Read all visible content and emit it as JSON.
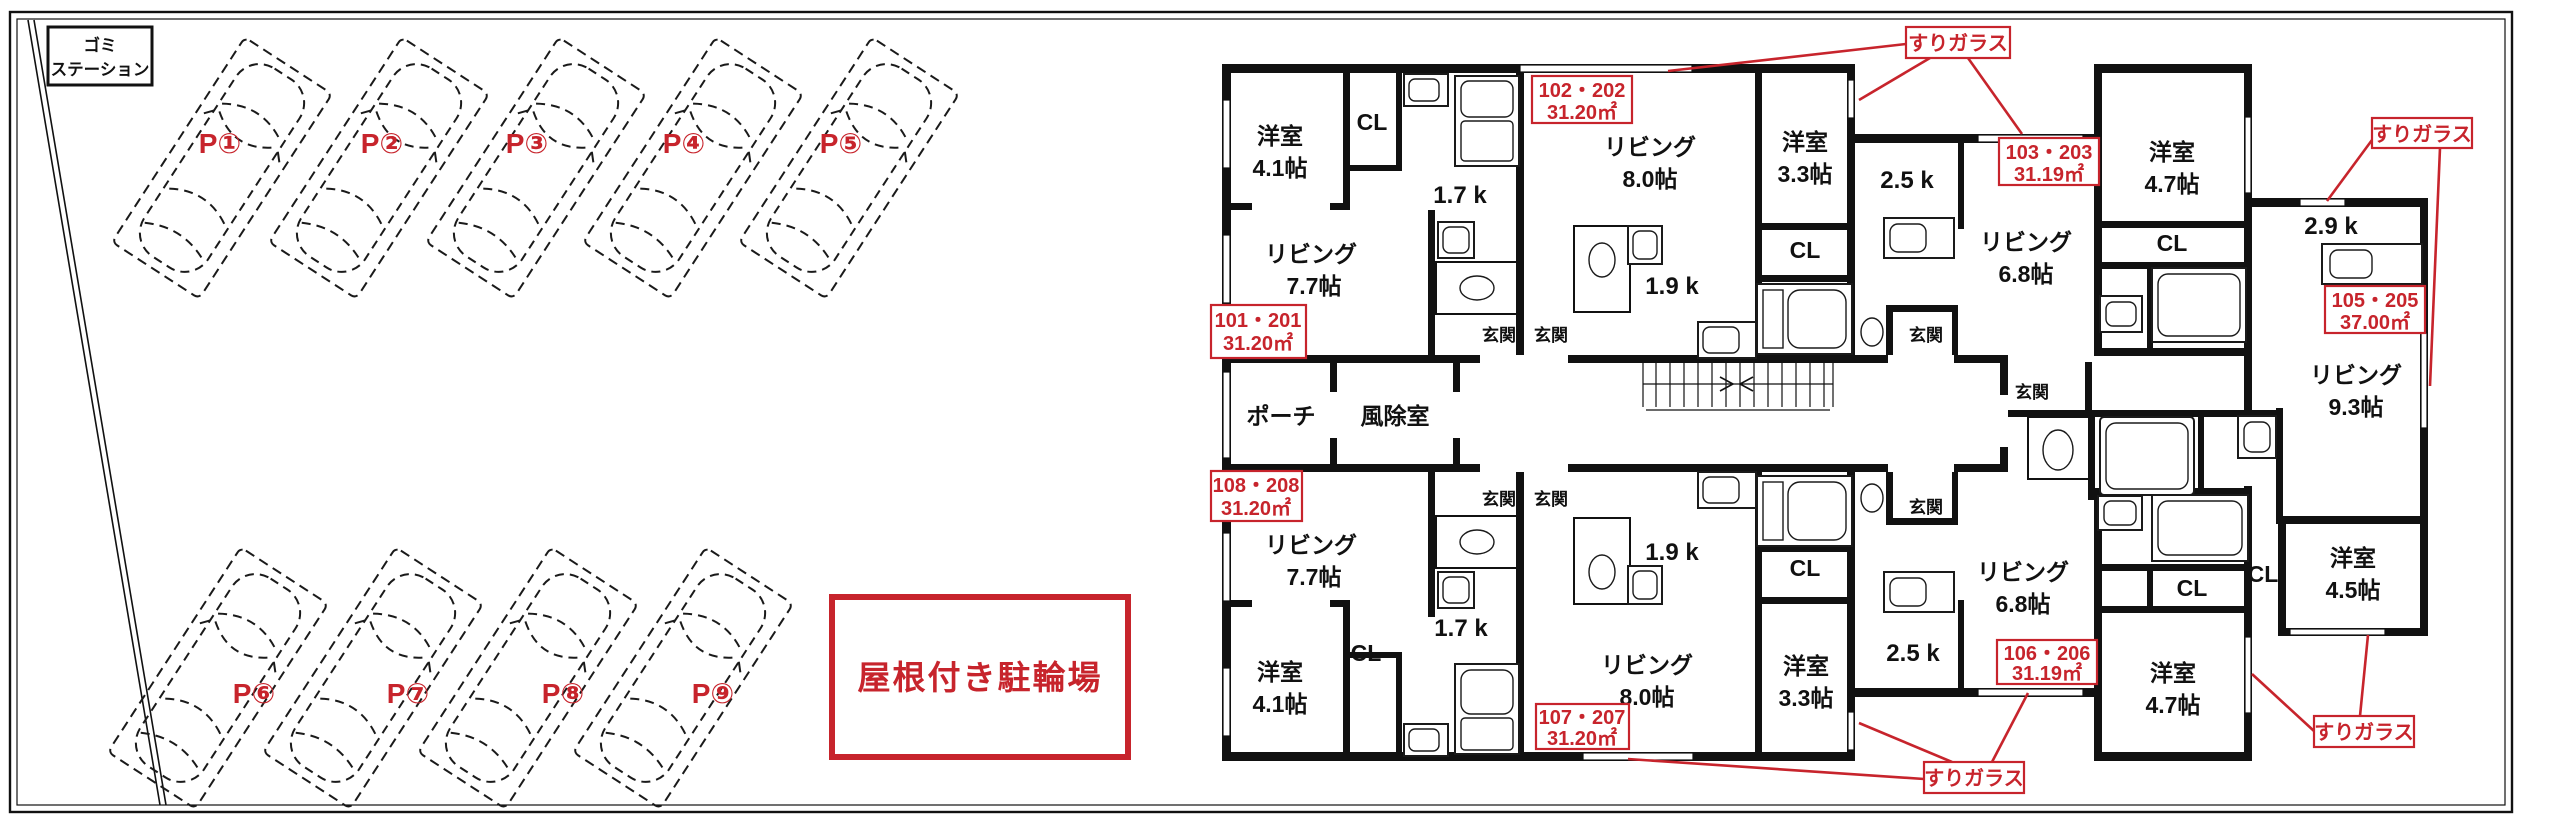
{
  "site": {
    "garbage_station_line1": "ゴミ",
    "garbage_station_line2": "ステーション",
    "bicycle_parking_label": "屋根付き駐輪場",
    "parking": [
      "P①",
      "P②",
      "P③",
      "P④",
      "P⑤",
      "P⑥",
      "P⑦",
      "P⑧",
      "P⑨"
    ]
  },
  "plan": {
    "rooms": {
      "yo41": {
        "name": "洋室",
        "size": "4.1帖"
      },
      "yo33": {
        "name": "洋室",
        "size": "3.3帖"
      },
      "yo47": {
        "name": "洋室",
        "size": "4.7帖"
      },
      "yo45": {
        "name": "洋室",
        "size": "4.5帖"
      },
      "li77": {
        "name": "リビング",
        "size": "7.7帖"
      },
      "li80": {
        "name": "リビング",
        "size": "8.0帖"
      },
      "li68": {
        "name": "リビング",
        "size": "6.8帖"
      },
      "li93": {
        "name": "リビング",
        "size": "9.3帖"
      }
    },
    "kitchens": {
      "k17": "1.7 k",
      "k19": "1.9 k",
      "k25": "2.5 k",
      "k29": "2.9 k"
    },
    "labels": {
      "cl": "CL",
      "genkan": "玄関",
      "porch": "ポーチ",
      "windbreak": "風除室"
    },
    "units": {
      "u101": {
        "no": "101・201",
        "area": "31.20㎡"
      },
      "u102": {
        "no": "102・202",
        "area": "31.20㎡"
      },
      "u103": {
        "no": "103・203",
        "area": "31.19㎡"
      },
      "u105": {
        "no": "105・205",
        "area": "37.00㎡"
      },
      "u106": {
        "no": "106・206",
        "area": "31.19㎡"
      },
      "u107": {
        "no": "107・207",
        "area": "31.20㎡"
      },
      "u108": {
        "no": "108・208",
        "area": "31.20㎡"
      }
    },
    "annotation": {
      "frosted_glass": "すりガラス"
    },
    "colors": {
      "annotation_red": "#c7242c",
      "wall": "#111111"
    }
  }
}
